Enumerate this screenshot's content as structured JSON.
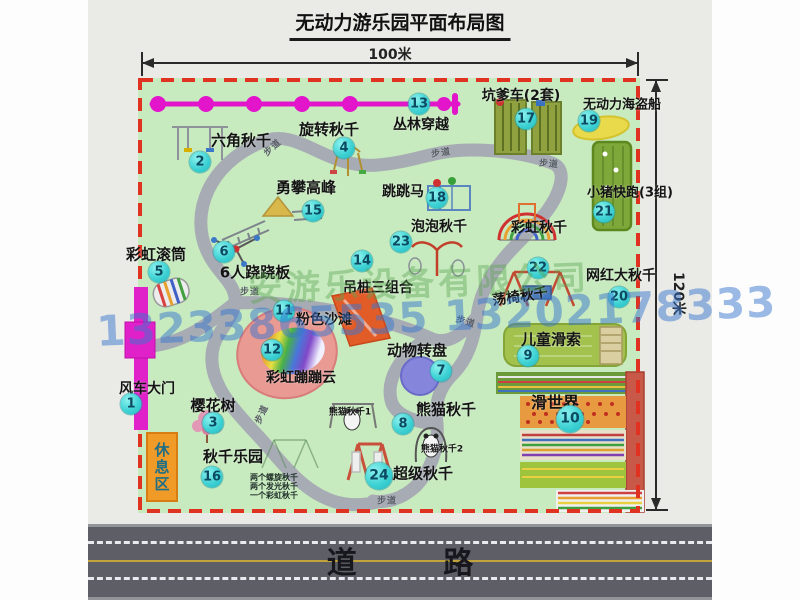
{
  "title": "无动力游乐园平面布局图",
  "dimensions": {
    "width_label": "100米",
    "height_label": "120米"
  },
  "road": {
    "label": "道 路"
  },
  "rest_area": {
    "label": "休息区"
  },
  "watermark": {
    "company": "安游乐设备有限公司",
    "phone": "13233865535 13202178333"
  },
  "colors": {
    "map_green": "#c8eabf",
    "border_red": "#e03220",
    "path_gray": "#a7acb4",
    "marker_cyan": "#2ec6cb",
    "zipline_magenta": "#e215cb",
    "road_gray": "#5e5e66",
    "rest_orange": "#f09a28",
    "beach_pink": "#e89a93",
    "pirate_yellow": "#e9da4b"
  },
  "map": {
    "walkway_label": "步道",
    "pois": [
      {
        "num": "1",
        "label": "风车大门",
        "mx": 131,
        "my": 404,
        "lx": 147,
        "ly": 388,
        "fs": 14
      },
      {
        "num": "2",
        "label": "六角秋千",
        "mx": 200,
        "my": 162,
        "lx": 241,
        "ly": 140,
        "fs": 15
      },
      {
        "num": "3",
        "label": "樱花树",
        "mx": 213,
        "my": 423,
        "lx": 213,
        "ly": 405,
        "fs": 15
      },
      {
        "num": "4",
        "label": "旋转秋千",
        "mx": 344,
        "my": 148,
        "lx": 329,
        "ly": 129,
        "fs": 15
      },
      {
        "num": "5",
        "label": "彩虹滚筒",
        "mx": 159,
        "my": 272,
        "lx": 156,
        "ly": 254,
        "fs": 15
      },
      {
        "num": "6",
        "label": "6人跷跷板",
        "mx": 224,
        "my": 252,
        "lx": 255,
        "ly": 272,
        "fs": 15
      },
      {
        "num": "7",
        "label": "动物转盘",
        "mx": 441,
        "my": 371,
        "lx": 417,
        "ly": 350,
        "fs": 15
      },
      {
        "num": "8",
        "label": "熊猫秋千",
        "mx": 403,
        "my": 424,
        "lx": 446,
        "ly": 409,
        "fs": 15
      },
      {
        "num": "9",
        "label": "儿童滑索",
        "mx": 528,
        "my": 356,
        "lx": 551,
        "ly": 339,
        "fs": 15
      },
      {
        "num": "10",
        "label": "滑世界",
        "mx": 570,
        "my": 419,
        "lx": 555,
        "ly": 401,
        "fs": 16,
        "ms": 27
      },
      {
        "num": "11",
        "label": "粉色沙滩",
        "mx": 284,
        "my": 311,
        "lx": 324,
        "ly": 319,
        "fs": 14
      },
      {
        "num": "12",
        "label": "彩虹蹦蹦云",
        "mx": 272,
        "my": 350,
        "lx": 301,
        "ly": 377,
        "fs": 14
      },
      {
        "num": "13",
        "label": "丛林穿越",
        "mx": 419,
        "my": 104,
        "lx": 421,
        "ly": 124,
        "fs": 14
      },
      {
        "num": "14",
        "label": "吊桩三组合",
        "mx": 362,
        "my": 261,
        "lx": 378,
        "ly": 287,
        "fs": 14
      },
      {
        "num": "15",
        "label": "勇攀高峰",
        "mx": 313,
        "my": 211,
        "lx": 306,
        "ly": 187,
        "fs": 15
      },
      {
        "num": "16",
        "label": "秋千乐园",
        "mx": 212,
        "my": 477,
        "lx": 233,
        "ly": 456,
        "fs": 15,
        "subs": [
          "两个螺旋秋千",
          "两个发光秋千",
          "一个彩虹秋千"
        ],
        "subs_x": 250,
        "subs_y": 472
      },
      {
        "num": "17",
        "label": "坑爹车(2套)",
        "mx": 526,
        "my": 119,
        "lx": 521,
        "ly": 95,
        "fs": 14
      },
      {
        "num": "18",
        "label": "跳跳马",
        "mx": 437,
        "my": 198,
        "lx": 403,
        "ly": 191,
        "fs": 14
      },
      {
        "num": "19",
        "label": "无动力海盗船",
        "mx": 589,
        "my": 121,
        "lx": 622,
        "ly": 103,
        "fs": 13
      },
      {
        "num": "20",
        "label": "网红大秋千",
        "mx": 619,
        "my": 297,
        "lx": 621,
        "ly": 275,
        "fs": 14
      },
      {
        "num": "21",
        "label": "小猪快跑(3组)",
        "mx": 604,
        "my": 212,
        "lx": 630,
        "ly": 191,
        "fs": 13
      },
      {
        "num": "22",
        "label": "荡椅秋千",
        "mx": 538,
        "my": 268,
        "lx": 520,
        "ly": 296,
        "fs": 14,
        "rot": -8
      },
      {
        "num": "23",
        "label": "泡泡秋千",
        "mx": 401,
        "my": 242,
        "lx": 439,
        "ly": 226,
        "fs": 14
      },
      {
        "num": "24",
        "label": "超级秋千",
        "mx": 379,
        "my": 476,
        "lx": 423,
        "ly": 473,
        "fs": 15,
        "ms": 27
      }
    ],
    "extra_labels": [
      {
        "text": "彩虹秋千",
        "x": 539,
        "y": 227,
        "fs": 14
      },
      {
        "text": "熊猫秋千1",
        "x": 350,
        "y": 411,
        "fs": 9
      },
      {
        "text": "熊猫秋千2",
        "x": 442,
        "y": 448,
        "fs": 9
      }
    ],
    "path_label_positions": [
      {
        "x": 272,
        "y": 147,
        "rot": -42
      },
      {
        "x": 441,
        "y": 152,
        "rot": -8
      },
      {
        "x": 549,
        "y": 163,
        "rot": 5
      },
      {
        "x": 250,
        "y": 291,
        "rot": 0
      },
      {
        "x": 261,
        "y": 414,
        "rot": -65
      },
      {
        "x": 466,
        "y": 321,
        "rot": 18
      },
      {
        "x": 387,
        "y": 500,
        "rot": 0
      }
    ]
  }
}
